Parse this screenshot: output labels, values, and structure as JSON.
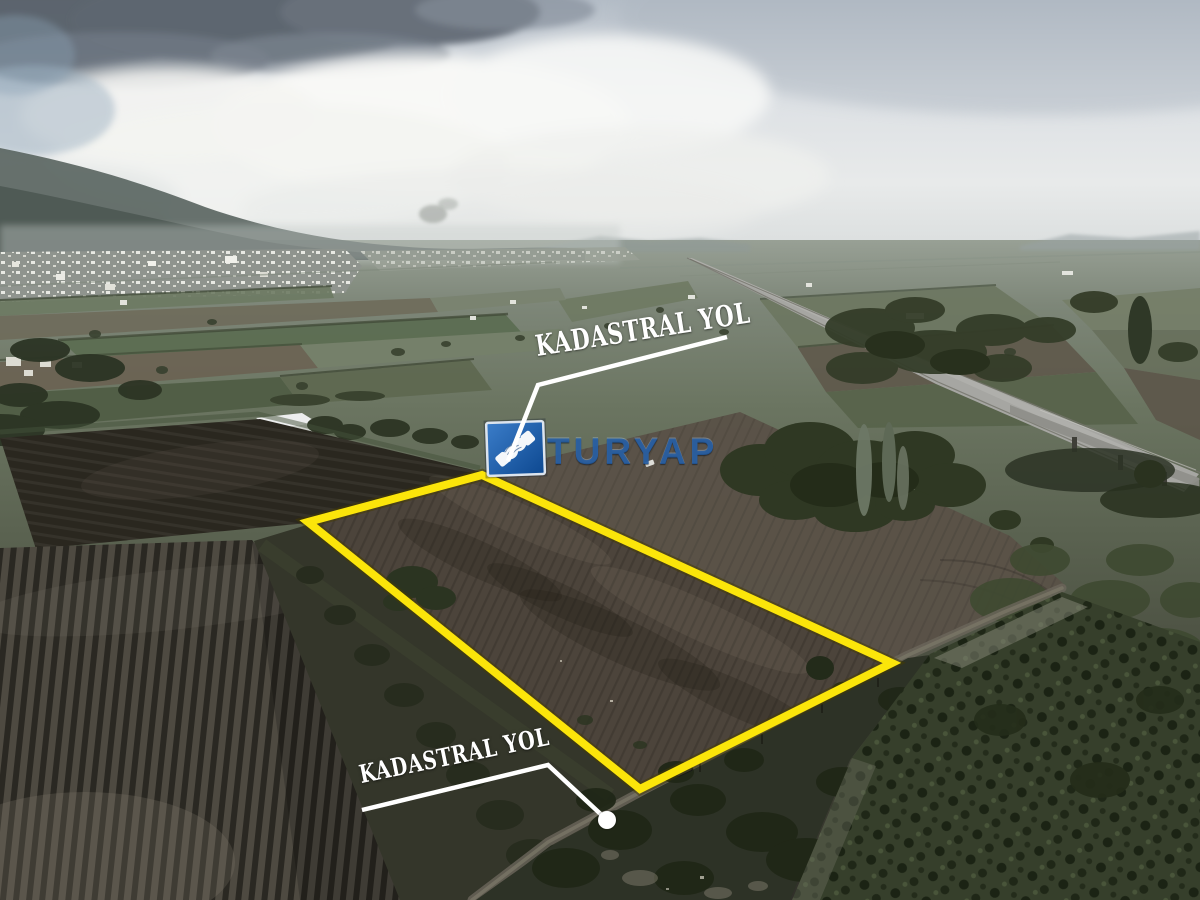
{
  "annotations": {
    "top_road_label": "KADASTRAL YOL",
    "bottom_road_label": "KADASTRAL YOL",
    "boundary_color": "#fbe50a",
    "leader_line_color": "#ffffff"
  },
  "watermark": {
    "brand_text": "TURYAP",
    "logo_square_color": "#1d63b5",
    "brand_text_color": "#2a6cb5",
    "icon": "handshake-icon"
  }
}
